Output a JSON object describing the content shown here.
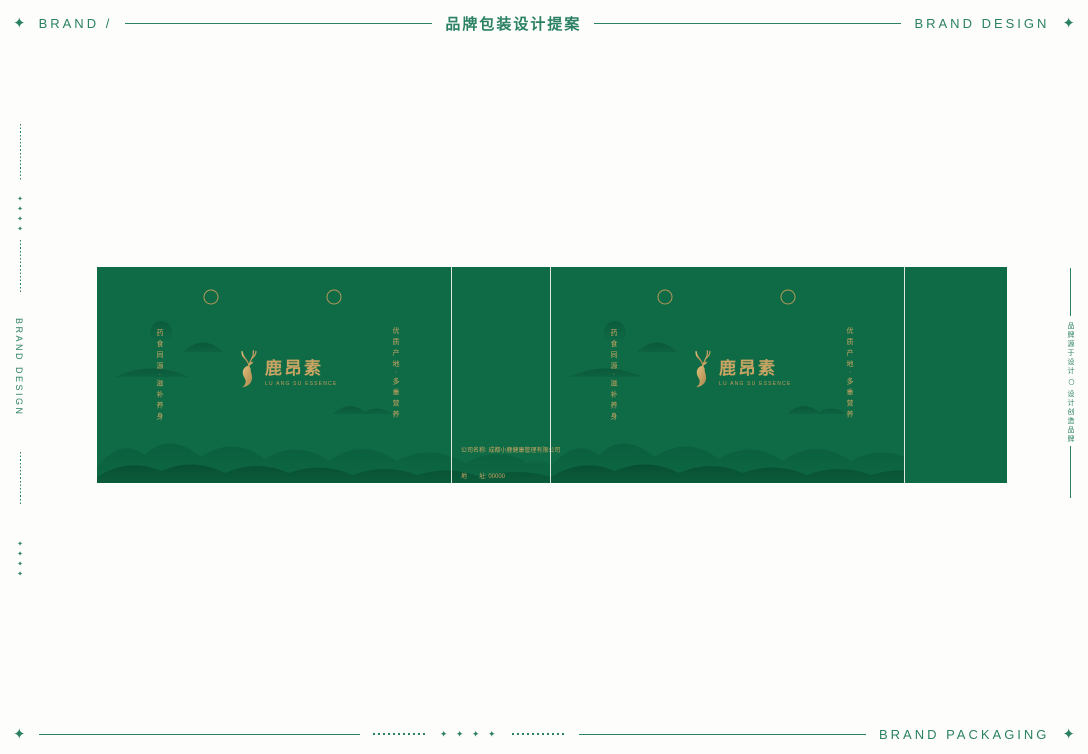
{
  "header": {
    "left_icon": "✦",
    "left_label": "BRAND /",
    "center_label": "品牌包装设计提案",
    "right_label": "BRAND DESIGN",
    "right_icon": "✦"
  },
  "sidebar_left": {
    "diamonds": "✦✦✦✦",
    "vertical_label": "BRAND DESIGN"
  },
  "sidebar_right": {
    "text_top": "品牌源于设计",
    "separator": "〇",
    "text_bottom": "设计创造品牌"
  },
  "packaging": {
    "logo": {
      "name_cn": "鹿昂素",
      "name_en": "LU ANG SU ESSENCE"
    },
    "slogan_left": "药食同源·滋补养身",
    "slogan_right": "优质产地·多重营养",
    "company_info": {
      "line1": "公司名称: 成都小鹿健康管理有限公司",
      "line2": "地　　址: 00000",
      "line3": "联系电话: 00000"
    }
  },
  "footer": {
    "left_icon": "✦",
    "center_diamonds": "✦ ✦ ✦ ✦",
    "right_label": "BRAND PACKAGING",
    "right_icon": "✦"
  },
  "colors": {
    "accent_green": "#2b8163",
    "package_green": "#0f6b45",
    "gold": "#c9a463"
  }
}
